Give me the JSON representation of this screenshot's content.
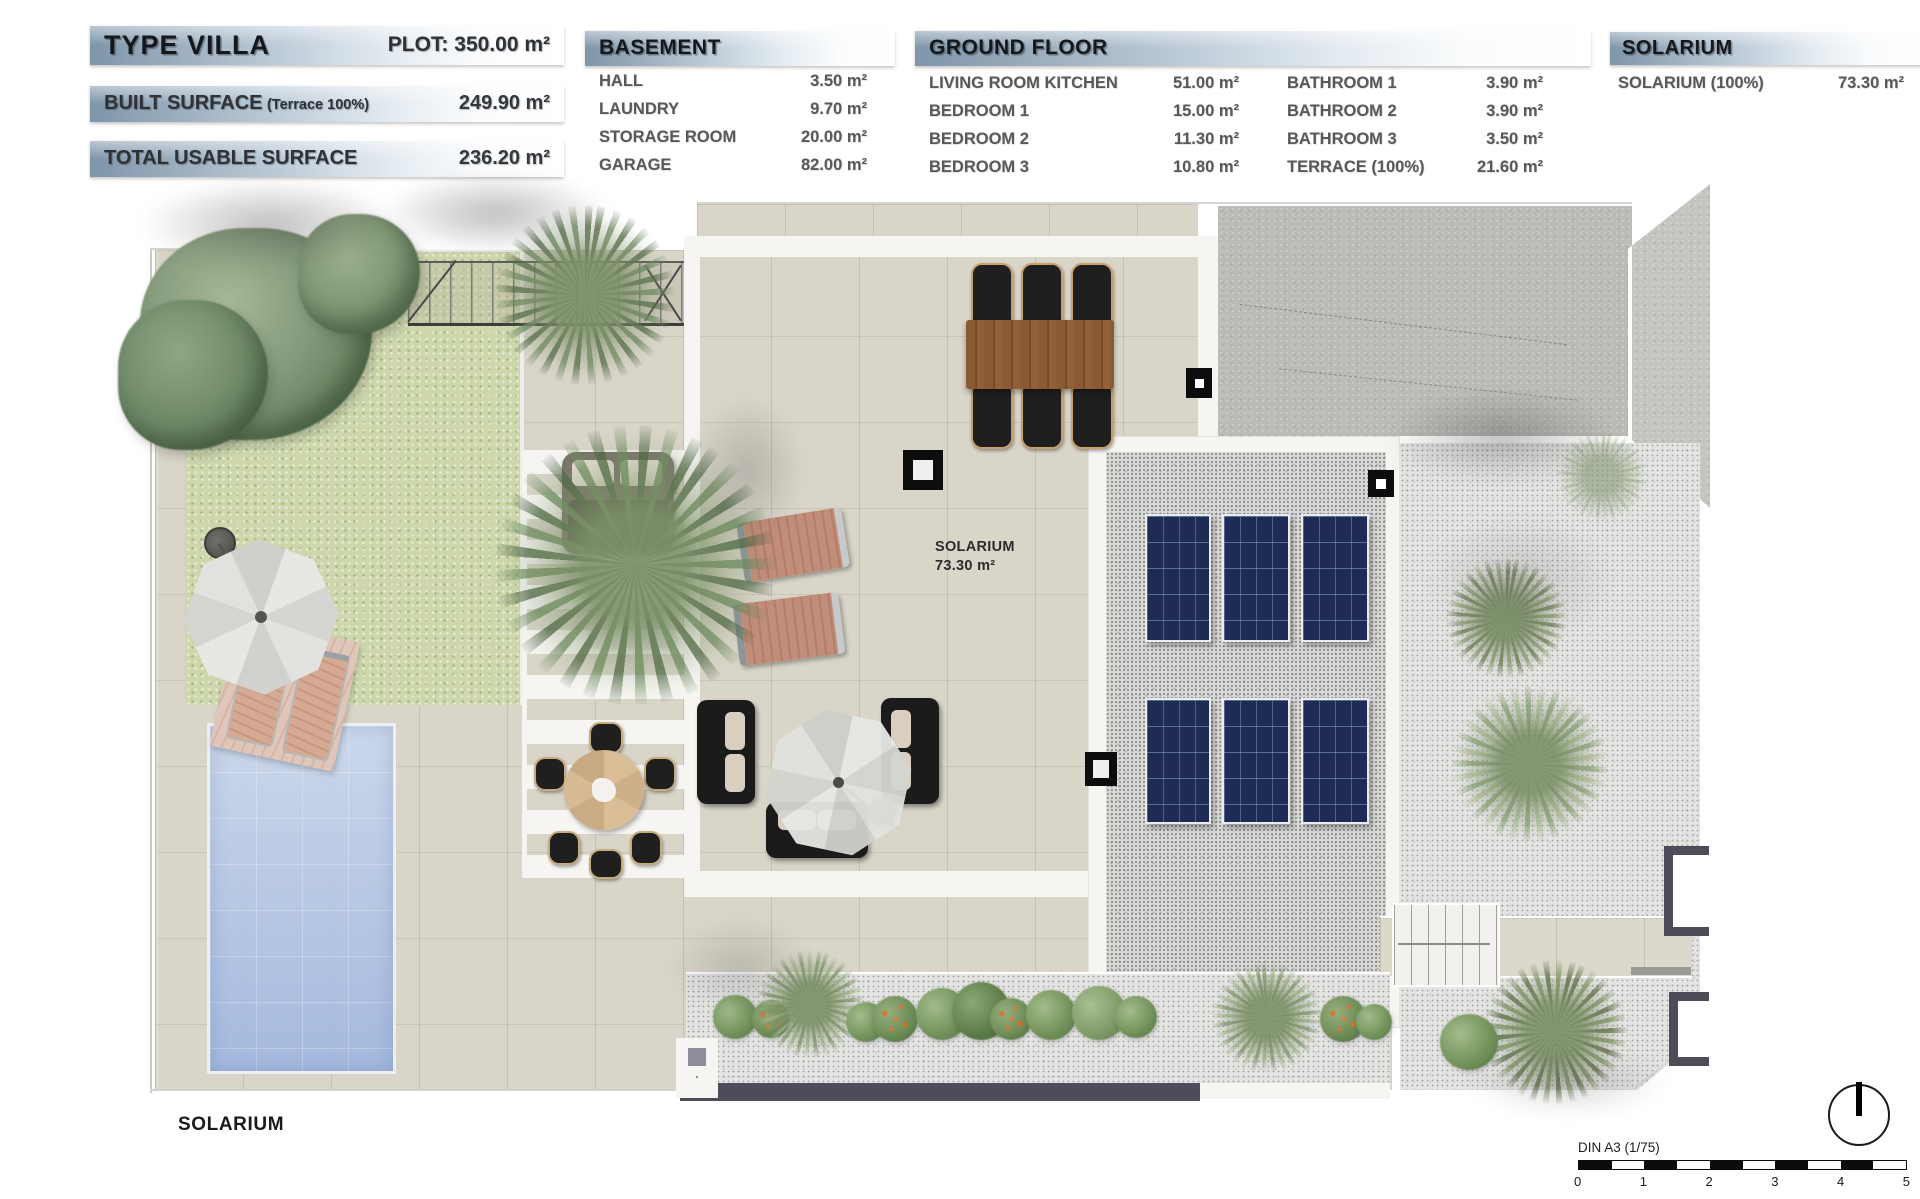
{
  "header": {
    "villa": {
      "title": "TYPE VILLA",
      "plot": "PLOT: 350.00 m²",
      "built_surface_label": "BUILT SURFACE",
      "built_surface_note": "(Terrace 100%)",
      "built_surface_value": "249.90 m²",
      "usable_surface_label": "TOTAL USABLE SURFACE",
      "usable_surface_value": "236.20 m²"
    },
    "basement": {
      "title": "BASEMENT",
      "rows": [
        {
          "label": "HALL",
          "value": "3.50 m²"
        },
        {
          "label": "LAUNDRY",
          "value": "9.70 m²"
        },
        {
          "label": "STORAGE ROOM",
          "value": "20.00 m²"
        },
        {
          "label": "GARAGE",
          "value": "82.00 m²"
        }
      ]
    },
    "ground_floor": {
      "title": "GROUND FLOOR",
      "col1": [
        {
          "label": "LIVING ROOM KITCHEN",
          "value": "51.00 m²"
        },
        {
          "label": "BEDROOM 1",
          "value": "15.00 m²"
        },
        {
          "label": "BEDROOM 2",
          "value": "11.30 m²"
        },
        {
          "label": "BEDROOM 3",
          "value": "10.80 m²"
        }
      ],
      "col2": [
        {
          "label": "BATHROOM 1",
          "value": "3.90 m²"
        },
        {
          "label": "BATHROOM 2",
          "value": "3.90 m²"
        },
        {
          "label": "BATHROOM 3",
          "value": "3.50 m²"
        },
        {
          "label": "TERRACE (100%)",
          "value": "21.60 m²"
        }
      ]
    },
    "solarium_table": {
      "title": "SOLARIUM",
      "rows": [
        {
          "label": "SOLARIUM (100%)",
          "value": "73.30 m²"
        }
      ]
    }
  },
  "plan": {
    "room_label": {
      "name": "SOLARIUM",
      "area": "73.30 m²"
    },
    "caption": "SOLARIUM",
    "scale_bar": {
      "label": "DIN A3 (1/75)",
      "ticks": [
        "0",
        "1",
        "2",
        "3",
        "4",
        "5"
      ]
    },
    "icons": {
      "north": "north-indicator",
      "roof_drain": "roof-drain-marker"
    }
  },
  "colors": {
    "legend_gradient_start": "#7f95a9",
    "legend_gradient_end": "#ffffff",
    "lawn": "#cdd7ab",
    "terrace": "#d9d5c9",
    "pool": "#a9bde3",
    "roof_concrete": "#bcbbb6",
    "gravel": "#e4e4e2",
    "solar_panel": "#1e2c55",
    "wall_slate": "#4e4c59",
    "wood_table": "#8b5a33"
  }
}
